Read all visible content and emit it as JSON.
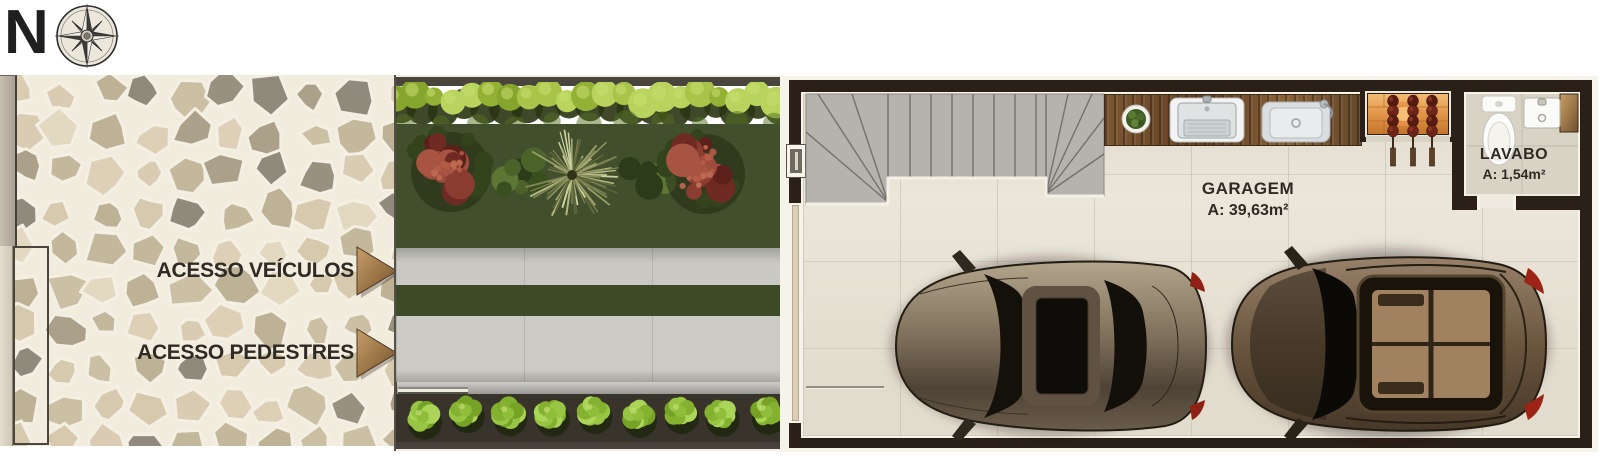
{
  "palette": {
    "background": "#ffffff",
    "wall_dark": "#2b2017",
    "outline_white": "#f6f3ea",
    "garage_floor": "#ebe6da",
    "stone_joint": "#f2ecdf",
    "hedge_green": "#9cbd3c",
    "lawn_green": "#414f2d",
    "concrete": "#cac9c3",
    "red_bush": "#8a3c30",
    "arrow_wood": "#a5804f",
    "bbq_glow": "#e09a4a",
    "text_dark": "#2e2a24"
  },
  "compass": {
    "north_label": "N"
  },
  "site": {
    "vehicle_access_label": "ACESSO VEÍCULOS",
    "pedestrian_access_label": "ACESSO PEDESTRES"
  },
  "rooms": {
    "garage": {
      "name": "GARAGEM",
      "area": "A: 39,63m²"
    },
    "lavabo": {
      "name": "LAVABO",
      "area": "A: 1,54m²"
    }
  }
}
